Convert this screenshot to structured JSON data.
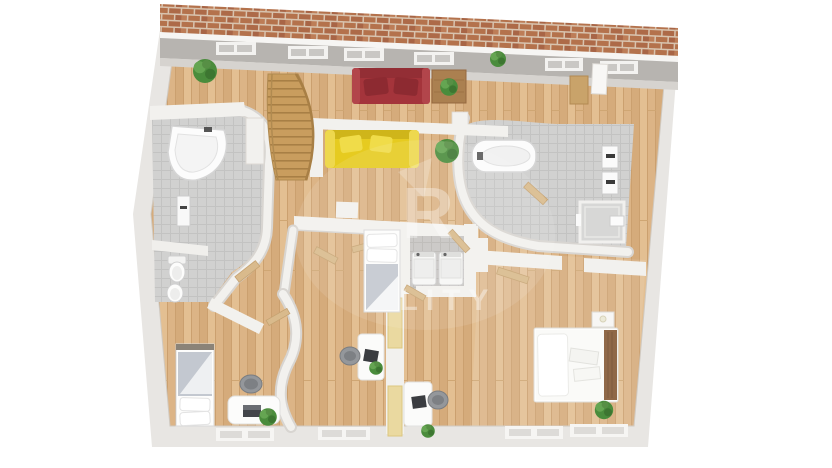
{
  "meta": {
    "title": "3D top-down floor plan render",
    "canvas": {
      "width": 832,
      "height": 468
    }
  },
  "watermark": {
    "monogram": "R",
    "text": "LITY",
    "color": "#ffffff"
  },
  "palette": {
    "background": "#ffffff",
    "roof_brick": "#b4724c",
    "roof_mortar": "#d8c3ae",
    "wall": "#e8e6e3",
    "wall_white": "#f2f1ee",
    "wall_shadow": "#d8d5d1",
    "ceiling_band": "#b7b4b0",
    "ceiling_light": "#d6d3cf",
    "floor_wood": "#dcb486",
    "floor_wood_dark": "#cba06f",
    "floor_wood_light": "#e3bf92",
    "tile_light": "#d1d1d0",
    "tile_dark": "#c7c5c2",
    "sofa_red": "#a4343b",
    "sofa_yellow": "#e6cb20",
    "stair_wood": "#c99d5e",
    "door_wood": "#d9ba8c",
    "pine_panel": "#ead9a0",
    "bed_linen": "#fdfdfc",
    "blanket_grey": "#c3c8d0",
    "headboard_brown": "#8f6848",
    "plant_green": "#4a8c3c",
    "fixture_white": "#fbfbfb",
    "chair_grey": "#94979b"
  },
  "scene": {
    "rooms": [
      {
        "id": "living-room-top",
        "floor": "wood",
        "furniture": [
          "red-sofa",
          "coffee-table",
          "yellow-sofa",
          "curved-staircase",
          "potted-plants",
          "wall-desk",
          "white-door"
        ]
      },
      {
        "id": "bathroom-left",
        "floor": "tile",
        "fixtures": [
          "corner-bathtub",
          "towel-radiator",
          "partition",
          "toilet",
          "bidet"
        ]
      },
      {
        "id": "bathroom-right",
        "floor": "tile",
        "fixtures": [
          "bathtub",
          "shower-cabin",
          "wall-radiator",
          "wall-radiator",
          "small-basin"
        ]
      },
      {
        "id": "utility-room",
        "floor": "tile",
        "fixtures": [
          "washing-machine",
          "dryer"
        ]
      },
      {
        "id": "sleeping-nook-center",
        "floor": "wood",
        "furniture": [
          "single-bed"
        ]
      },
      {
        "id": "bedroom-left",
        "floor": "wood",
        "furniture": [
          "single-bed",
          "desk",
          "office-chair",
          "laptop",
          "potted-plant"
        ]
      },
      {
        "id": "office-nook",
        "floor": "wood",
        "furniture": [
          "desk",
          "desk",
          "office-chair",
          "office-chair",
          "laptop",
          "laptop",
          "potted-plant",
          "potted-plant"
        ]
      },
      {
        "id": "bedroom-right",
        "floor": "wood",
        "furniture": [
          "double-bed",
          "nightstand",
          "potted-plant"
        ]
      },
      {
        "id": "hallway",
        "floor": "wood",
        "furniture": [
          "open-doors"
        ]
      }
    ],
    "windows": {
      "skylights_top": 6,
      "bottom_wall": 4
    }
  }
}
